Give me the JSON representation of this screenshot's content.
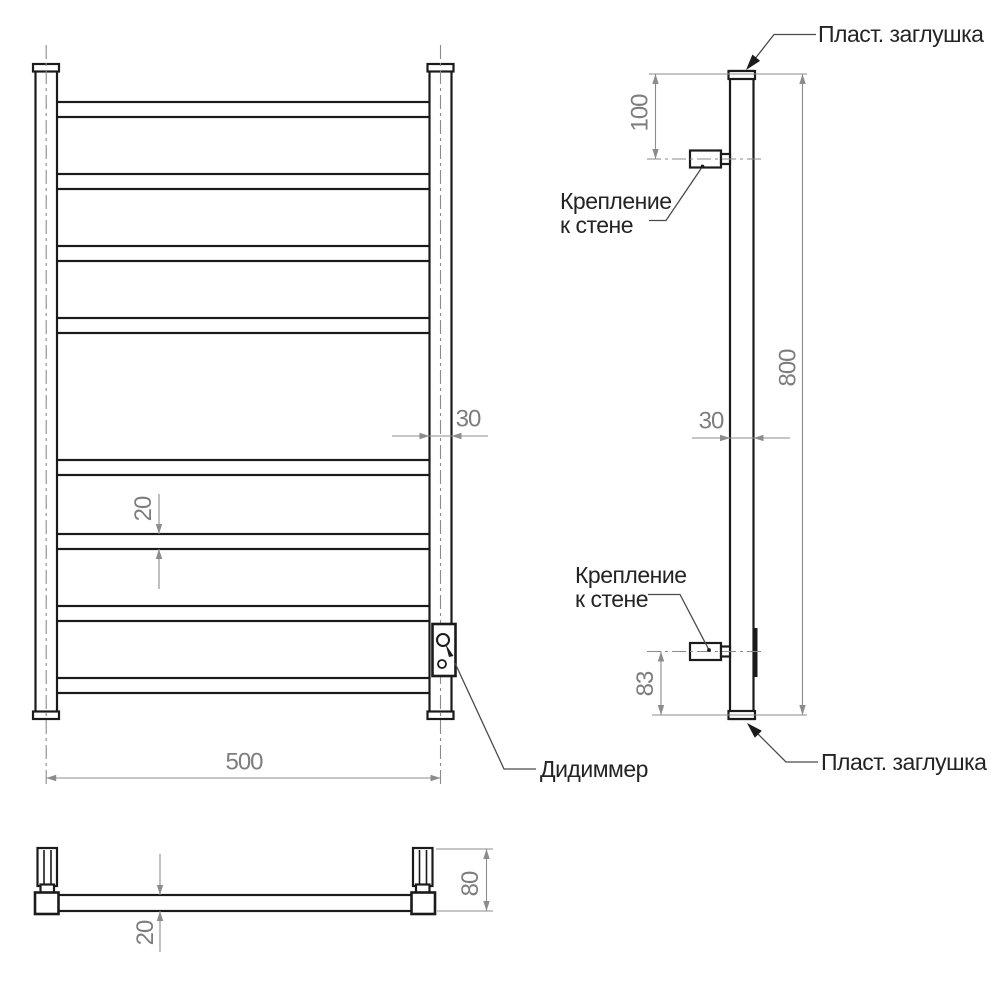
{
  "drawing": {
    "type": "technical-drawing",
    "subject": "ladder towel rail, three orthographic views",
    "colors": {
      "object_line": "#1b1b1b",
      "dimension_line": "#8c8c8c",
      "dimension_text": "#7d7d7d",
      "label_text": "#242424",
      "background": "#ffffff"
    },
    "front_view": {
      "width_dim": "500",
      "rung_thickness_dim": "20",
      "post_width_dim": "30",
      "dimmer_label": "Дидиммер"
    },
    "side_view": {
      "height_dim": "800",
      "top_mount_offset_dim": "100",
      "bottom_mount_offset_dim": "83",
      "tube_depth_dim": "30",
      "plug_label": "Пласт. заглушка",
      "mount_label_line1": "Крепление",
      "mount_label_line2": "к стене"
    },
    "bottom_view": {
      "tube_depth_dim": "20",
      "overall_depth_dim": "80"
    }
  }
}
